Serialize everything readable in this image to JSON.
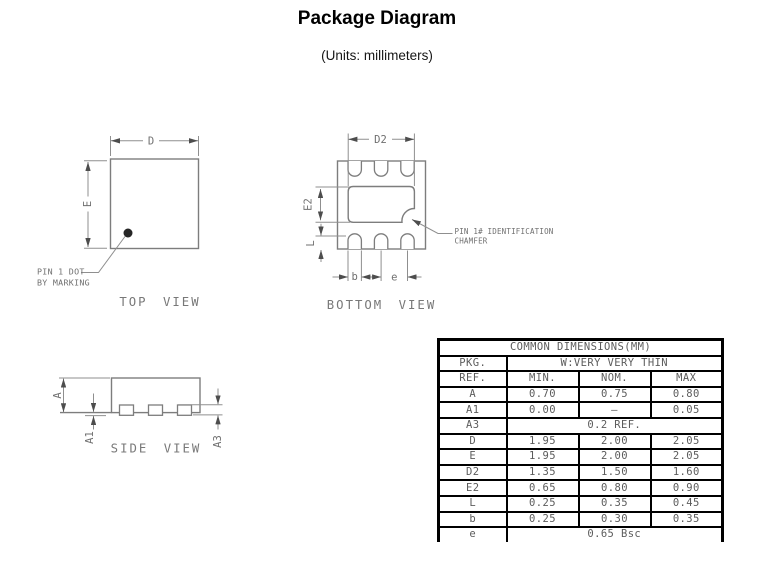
{
  "title": "Package Diagram",
  "subtitle": "(Units: millimeters)",
  "colors": {
    "drawing_line": "#7d7d7d",
    "dimension_line": "#8f8f8f",
    "drawing_text": "#6f6f6f",
    "table_border": "#000000",
    "table_text": "#5c5c5c",
    "background": "#ffffff"
  },
  "top_view": {
    "label": "TOP VIEW",
    "dim_d": "D",
    "dim_e": "E",
    "pin1_note_line1": "PIN 1 DOT",
    "pin1_note_line2": "BY MARKING"
  },
  "bottom_view": {
    "label": "BOTTOM VIEW",
    "dim_d2": "D2",
    "dim_e2": "E2",
    "dim_l": "L",
    "dim_b": "b",
    "dim_e_pitch": "e",
    "chamfer_note_line1": "PIN 1# IDENTIFICATION",
    "chamfer_note_line2": "CHAMFER"
  },
  "side_view": {
    "label": "SIDE VIEW",
    "dim_a": "A",
    "dim_a1": "A1",
    "dim_a3": "A3"
  },
  "table": {
    "title": "COMMON DIMENSIONS(MM)",
    "pkg_label": "PKG.",
    "pkg_value": "W:VERY VERY THIN",
    "columns": [
      "REF.",
      "MIN.",
      "NOM.",
      "MAX"
    ],
    "rows": [
      {
        "ref": "A",
        "min": "0.70",
        "nom": "0.75",
        "max": "0.80"
      },
      {
        "ref": "A1",
        "min": "0.00",
        "nom": "–",
        "max": "0.05"
      },
      {
        "ref": "A3",
        "span": "0.2 REF."
      },
      {
        "ref": "D",
        "min": "1.95",
        "nom": "2.00",
        "max": "2.05"
      },
      {
        "ref": "E",
        "min": "1.95",
        "nom": "2.00",
        "max": "2.05"
      },
      {
        "ref": "D2",
        "min": "1.35",
        "nom": "1.50",
        "max": "1.60"
      },
      {
        "ref": "E2",
        "min": "0.65",
        "nom": "0.80",
        "max": "0.90"
      },
      {
        "ref": "L",
        "min": "0.25",
        "nom": "0.35",
        "max": "0.45"
      },
      {
        "ref": "b",
        "min": "0.25",
        "nom": "0.30",
        "max": "0.35"
      },
      {
        "ref": "e",
        "span": "0.65 Bsc"
      }
    ]
  }
}
